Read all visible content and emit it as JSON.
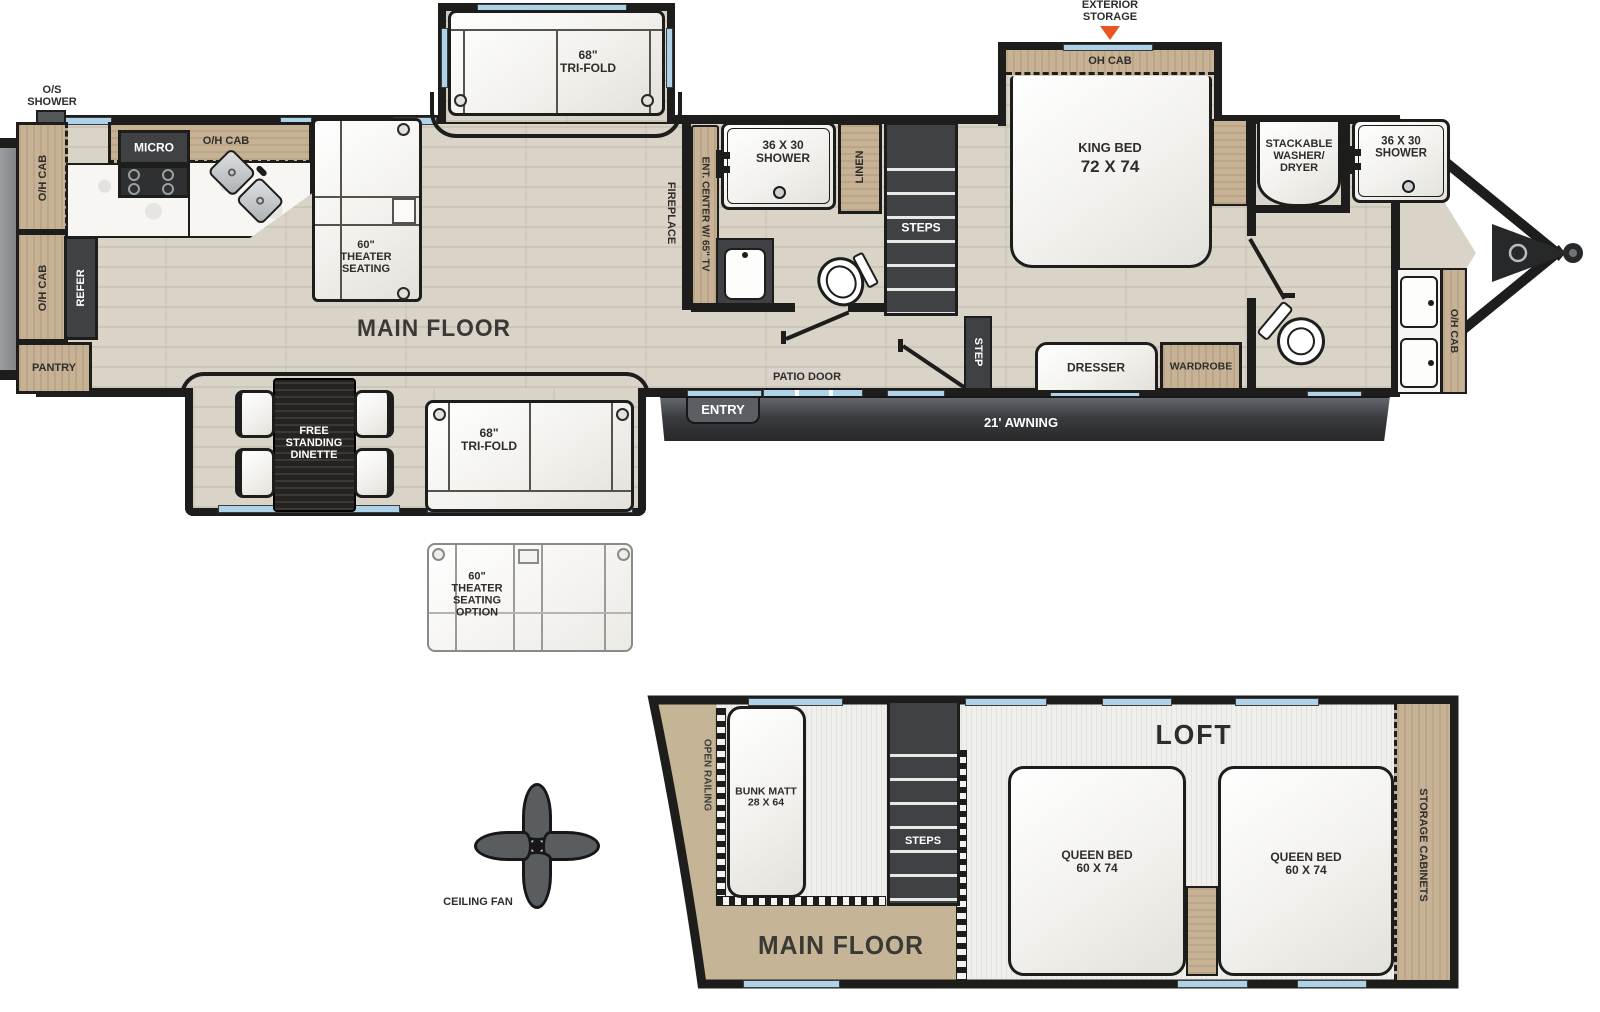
{
  "colors": {
    "wall": "#1d1d1b",
    "wood": "#c7b295",
    "floor": "#d9d3c8",
    "dark": "#3f4144",
    "window": "#aed3e8",
    "accent_orange": "#e8571f",
    "furniture_white": "#f6f5f2"
  },
  "main": {
    "os_shower": "O/S\nSHOWER",
    "oh_cab_left_top": "O/H CAB",
    "oh_cab_left_bottom": "O/H CAB",
    "micro": "MICRO",
    "oh_cab_kitchen": "O/H CAB",
    "refer": "REFER",
    "pantry": "PANTRY",
    "theater_seating": "60\"\nTHEATER\nSEATING",
    "main_floor": "MAIN FLOOR",
    "trifold_top": "68\"\nTRI-FOLD",
    "fireplace": "FIREPLACE",
    "ent_center": "ENT. CENTER W/ 65\" TV",
    "shower_mid": "36 X 30\nSHOWER",
    "linen": "LINEN",
    "steps": "STEPS",
    "step": "STEP",
    "patio_door": "PATIO DOOR",
    "entry": "ENTRY",
    "awning": "21' AWNING",
    "exterior_storage": "EXTERIOR\nSTORAGE",
    "oh_cab_king": "OH CAB",
    "king_bed_title": "KING BED",
    "king_bed_size": "72 X 74",
    "dresser": "DRESSER",
    "wardrobe": "WARDROBE",
    "washer_dryer": "STACKABLE\nWASHER/\nDRYER",
    "shower_front": "36 X 30\nSHOWER",
    "oh_cab_front": "O/H CAB"
  },
  "slide": {
    "dinette": "FREE\nSTANDING\nDINETTE",
    "trifold": "68\"\nTRI-FOLD",
    "theater_option": "60\"\nTHEATER\nSEATING\nOPTION"
  },
  "loft": {
    "open_railing": "OPEN RAILING",
    "bunk": "BUNK MATT\n28 X 64",
    "steps": "STEPS",
    "main_floor": "MAIN FLOOR",
    "title": "LOFT",
    "queen1": "QUEEN BED\n60 X 74",
    "queen2": "QUEEN BED\n60 X 74",
    "storage": "STORAGE CABINETS"
  },
  "fan": {
    "label": "CEILING FAN"
  }
}
